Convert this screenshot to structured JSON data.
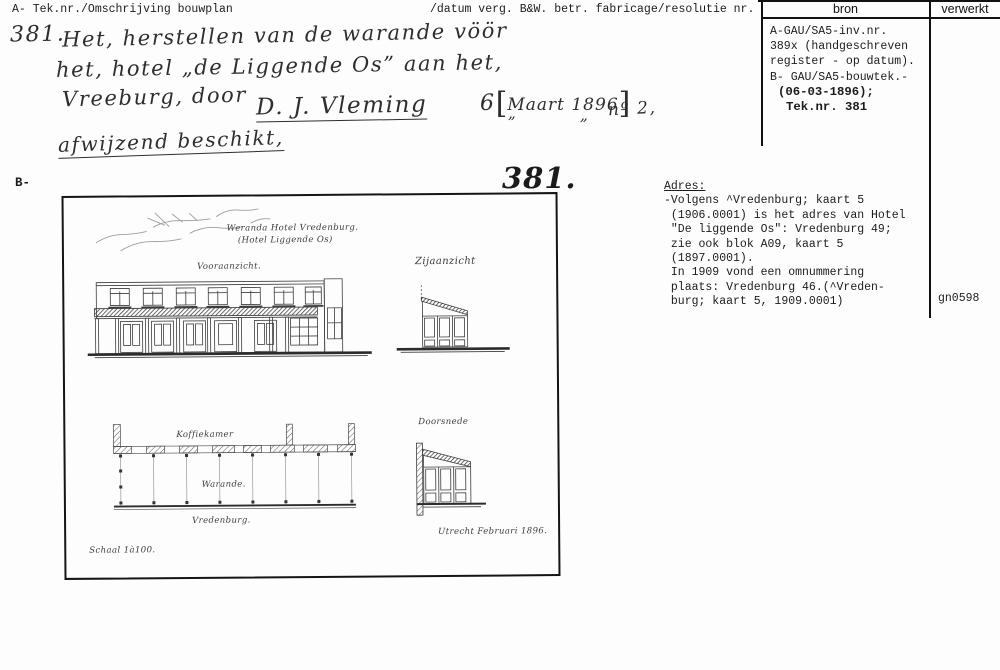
{
  "header": {
    "col_a": "A- Tek.nr./Omschrijving bouwplan",
    "col_datum": "/datum verg. B&W. betr. fabricage/resolutie nr.",
    "col_bron": "bron",
    "col_verwerkt": "verwerkt"
  },
  "handwritten": {
    "number": "381.",
    "line1": "Het, herstellen van de warande vöör",
    "line2": "het, hotel „de Liggende Os” aan het,",
    "line3": "Vreeburg, door",
    "signature": "D. J. Vleming",
    "date_prefix": "6",
    "bracket_open": "[",
    "date_bracket": "Maart 1896",
    "bracket_close": "]",
    "ditto1": "„",
    "ditto2": "„",
    "number_ref": "nº 2,",
    "decision": "afwijzend beschikt,"
  },
  "bron": {
    "lines": [
      "A-GAU/SA5-inv.nr.",
      "389x (handgeschreven",
      "register - op datum).",
      "B- GAU/SA5-bouwtek.-"
    ],
    "bold_lines": [
      "(06-03-1896);",
      "Tek.nr. 381"
    ]
  },
  "section_b": {
    "label": "B-",
    "big_number": "381."
  },
  "adres": {
    "heading": "Adres:",
    "lines": [
      "-Volgens ^Vredenburg; kaart 5",
      " (1906.0001) is het adres van Hotel",
      " \"De liggende Os\": Vredenburg 49;",
      " zie ook blok A09, kaart 5",
      " (1897.0001).",
      " In 1909 vond een omnummering",
      " plaats: Vredenburg 46.(^Vreden-",
      " burg; kaart 5, 1909.0001)"
    ]
  },
  "verwerkt_value": "gn0598",
  "drawing": {
    "title_line1": "Weranda Hotel Vredenburg.",
    "title_line2": "(Hotel Liggende Os)",
    "label_front": "Vooraanzicht.",
    "label_side": "Zijaanzicht",
    "label_koffiekamer": "Koffiekamer",
    "label_warande": "Warande.",
    "label_vredenburg": "Vredenburg.",
    "label_section": "Doorsnede",
    "date_place": "Utrecht Februari 1896.",
    "scale": "Schaal 1à100."
  }
}
